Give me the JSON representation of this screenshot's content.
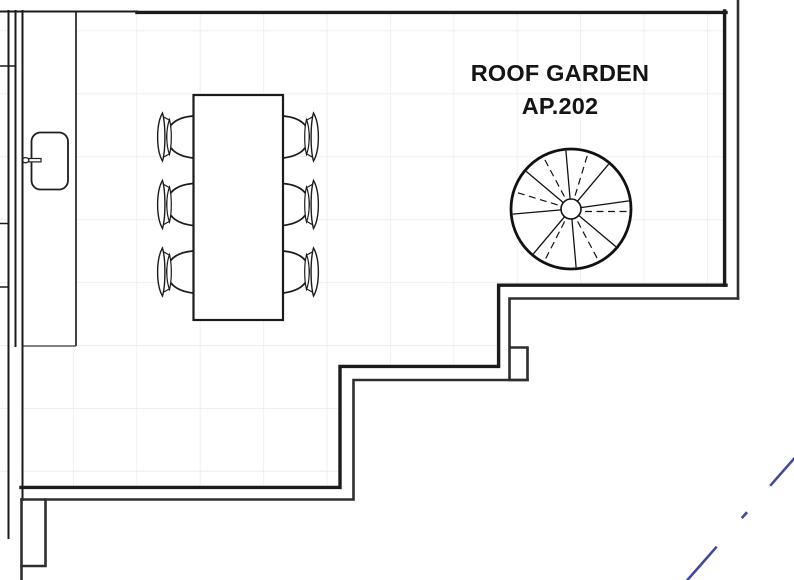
{
  "plan": {
    "room_label_line1": "ROOF GARDEN",
    "room_label_line2": "AP.202"
  },
  "colors": {
    "wall_line": "#1b1b1b",
    "outer_wall_line": "#2e2e2e",
    "grid_line": "#e9e9e9",
    "annotation_blue": "#3e4b9b"
  },
  "furniture": {
    "dining_chairs_count": 6,
    "dining_tables_count": 1,
    "spiral_staircases_count": 1
  }
}
